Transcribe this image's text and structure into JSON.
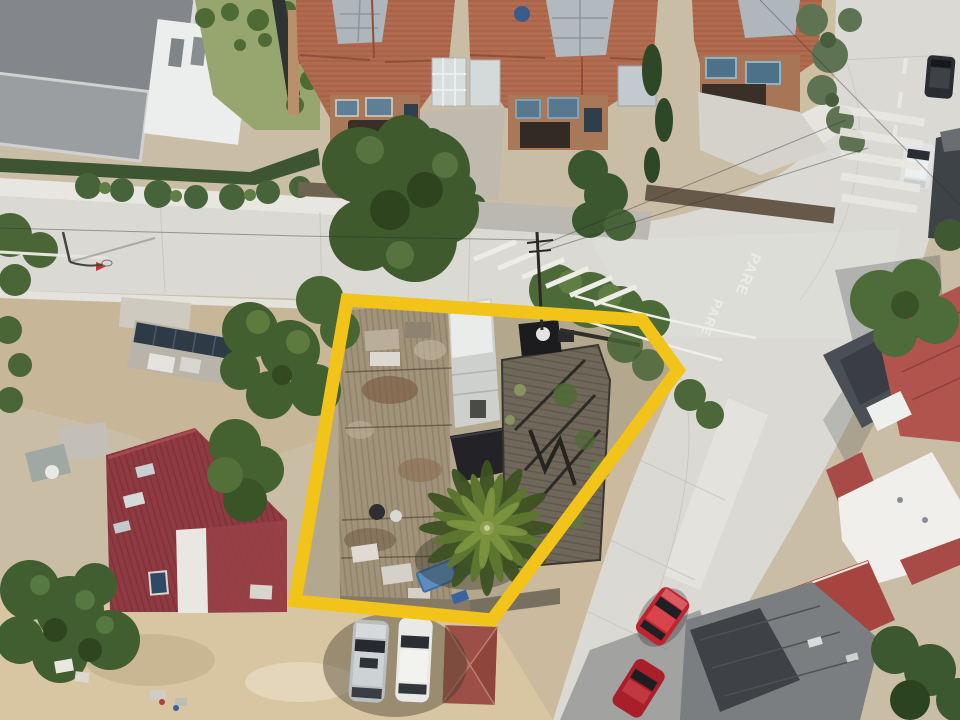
{
  "meta": {
    "kind": "aerial-drone-photograph",
    "subject": "corner property outlined in yellow at a street intersection",
    "width_px": 960,
    "height_px": 720
  },
  "road_markings": {
    "pare_upper": "PARE",
    "pare_lower": "PARE"
  },
  "boundary": {
    "label": "property-outline",
    "color": "#F2C318",
    "stroke_px": 13,
    "vertices": [
      [
        347,
        300
      ],
      [
        642,
        320
      ],
      [
        678,
        370
      ],
      [
        492,
        620
      ],
      [
        295,
        601
      ]
    ]
  },
  "palette": {
    "road_concrete": "#DAD9D4",
    "sidewalk": "#E8E6E0",
    "sand": "#D8C6A3",
    "terracotta_roof": "#B06A4F",
    "red_metal_roof": "#8E3A40",
    "salmon_roof": "#B2544E",
    "pool_water": "#4FC5BE",
    "tree_green": "#3F5A2D",
    "palm_green": "#5C7630",
    "deck_wood": "#6F675A",
    "dark_roof": "#232327"
  },
  "features": [
    "modern-house-with-pool",
    "terracotta-roof-houses",
    "outlined-corner-property",
    "corrugated-metal-roofs",
    "wooden-deck",
    "palm-tree",
    "blue-pickup-truck",
    "red-metal-roof-house",
    "sandy-lot",
    "parked-gray-suv",
    "parked-white-suv",
    "red-hip-roof-kiosk",
    "street-intersection",
    "pare-stop-markings",
    "pedestrian-crosswalks",
    "parked-red-cars",
    "white-flat-roof-building",
    "gray-construction-roofs",
    "street-trees",
    "utility-pole-power-lines"
  ]
}
